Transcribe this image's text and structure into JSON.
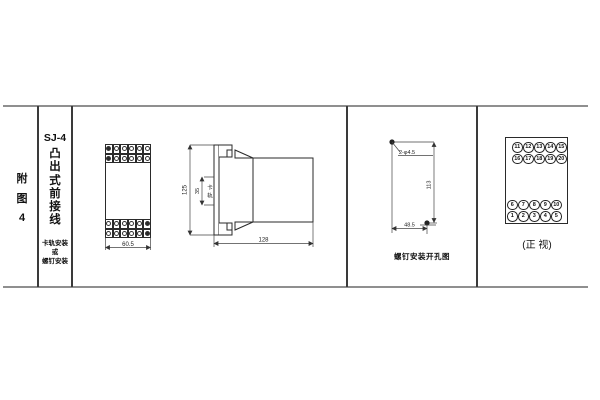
{
  "figure_index": {
    "chars": [
      "附",
      "图",
      "4"
    ]
  },
  "title": {
    "model": "SJ-4",
    "style_chars": [
      "凸",
      "出",
      "式",
      "前",
      "接",
      "线"
    ],
    "mount_lines": [
      "卡轨安装",
      "或",
      "螺钉安装"
    ]
  },
  "front_view": {
    "width_dim": "60.5"
  },
  "side_view": {
    "height_dim": "125",
    "rail_dim": "35",
    "rail_label": [
      "卡",
      "轨"
    ],
    "depth_dim": "128"
  },
  "drill_view": {
    "hole_label": "2-φ4.5",
    "height_dim": "113",
    "width_dim": "48.5",
    "caption": "螺钉安装开孔图"
  },
  "terminal_view": {
    "rows": [
      [
        "11",
        "12",
        "13",
        "14",
        "15"
      ],
      [
        "16",
        "17",
        "18",
        "19",
        "20"
      ],
      [
        "6",
        "7",
        "8",
        "9",
        "10"
      ],
      [
        "1",
        "2",
        "3",
        "4",
        "5"
      ]
    ],
    "caption": "(正 视)"
  }
}
